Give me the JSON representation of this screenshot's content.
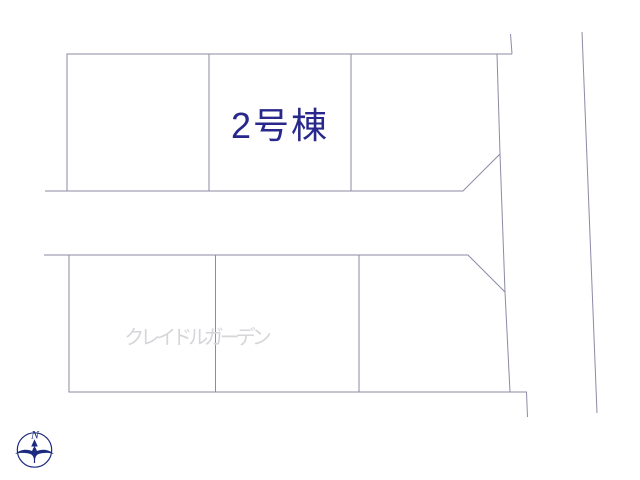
{
  "plan": {
    "background_color": "#ffffff",
    "line_color": "#8b8ba6",
    "lots": {
      "highlighted": {
        "label": "2号棟",
        "fill": "#f6d493",
        "label_color": "#28288c"
      }
    },
    "watermark": {
      "text": "クレイドルガーデン",
      "color": "#d6d6da"
    },
    "compass": {
      "north_label": "N",
      "color": "#1c2b80"
    }
  }
}
